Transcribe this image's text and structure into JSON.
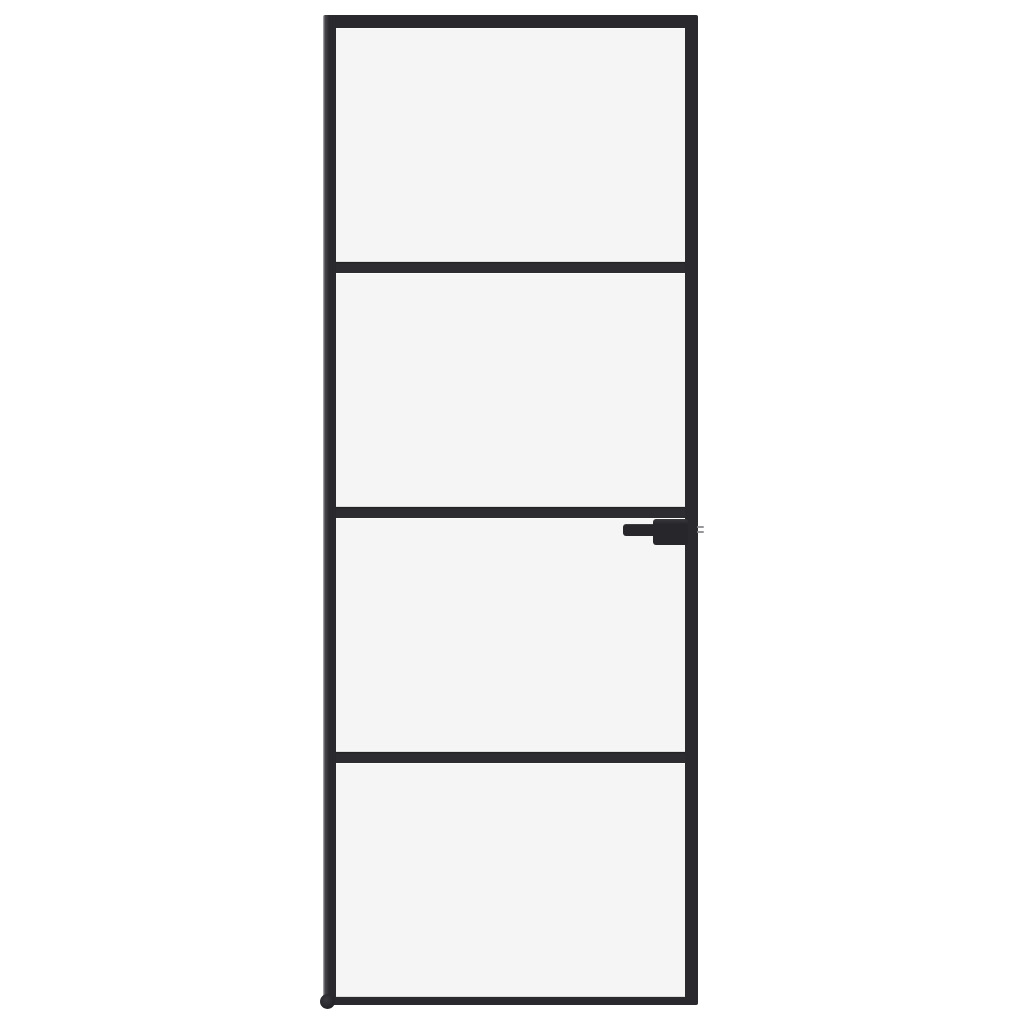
{
  "scene": {
    "kind": "product-photo",
    "subject": "interior glass door with black frame",
    "background_color": "#ffffff"
  },
  "door": {
    "panel_count": 4,
    "divider_count": 3,
    "handle_side": "right",
    "handle_type": "lever",
    "has_latch_bolt": true,
    "has_floor_pivot": true,
    "glass_finish": "frosted-light"
  },
  "colors": {
    "background": "#ffffff",
    "frame": "#2a2a2e",
    "frame-highlight": "#47474b",
    "frame-outer-edge": "#b9b9bc",
    "divider": "#2d2d31",
    "glass": "#f5f5f6",
    "handle": "#27272b",
    "handle-highlight": "#3a3a3e",
    "latch": "#97979b"
  }
}
